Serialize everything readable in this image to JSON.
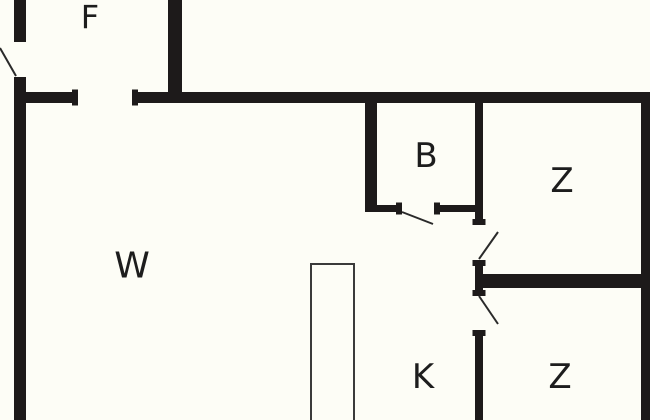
{
  "canvas": {
    "width": 650,
    "height": 420,
    "background_color": "#fdfdf6",
    "wall_color": "#1d1a1a",
    "door_line_color": "#2a2a2a",
    "counter_line_color": "#3a3a3a",
    "label_color": "#1d1d1d"
  },
  "plan": {
    "type": "floor-plan",
    "rooms": [
      {
        "id": "f",
        "label": "F",
        "cx": 90,
        "cy": 17,
        "font_size": 32
      },
      {
        "id": "w",
        "label": "W",
        "cx": 132,
        "cy": 266,
        "font_size": 36
      },
      {
        "id": "b",
        "label": "B",
        "cx": 426,
        "cy": 156,
        "font_size": 34
      },
      {
        "id": "z-top",
        "label": "Z",
        "cx": 562,
        "cy": 181,
        "font_size": 34
      },
      {
        "id": "k",
        "label": "K",
        "cx": 423,
        "cy": 377,
        "font_size": 34
      },
      {
        "id": "z-bottom",
        "label": "Z",
        "cx": 560,
        "cy": 377,
        "font_size": 34
      }
    ],
    "walls": [
      {
        "id": "left-wall-upper",
        "x": 14,
        "y": 0,
        "w": 12,
        "h": 42
      },
      {
        "id": "left-wall-main",
        "x": 14,
        "y": 77,
        "w": 12,
        "h": 343
      },
      {
        "id": "f-right-wall",
        "x": 168,
        "y": 0,
        "w": 14,
        "h": 103
      },
      {
        "id": "top-wall-left-seg",
        "x": 14,
        "y": 92,
        "w": 64,
        "h": 11
      },
      {
        "id": "top-wall-main-seg",
        "x": 132,
        "y": 92,
        "w": 518,
        "h": 11
      },
      {
        "id": "right-wall",
        "x": 641,
        "y": 92,
        "w": 9,
        "h": 328
      },
      {
        "id": "b-left-wall",
        "x": 365,
        "y": 103,
        "w": 12,
        "h": 109
      },
      {
        "id": "b-bottom-wall-left",
        "x": 365,
        "y": 205,
        "w": 37,
        "h": 7
      },
      {
        "id": "b-bottom-wall-right",
        "x": 434,
        "y": 205,
        "w": 49,
        "h": 7
      },
      {
        "id": "corridor-wall-upper",
        "x": 475,
        "y": 103,
        "w": 8,
        "h": 122
      },
      {
        "id": "corridor-wall-mid",
        "x": 475,
        "y": 260,
        "w": 8,
        "h": 36
      },
      {
        "id": "corridor-wall-lower",
        "x": 475,
        "y": 330,
        "w": 8,
        "h": 90
      },
      {
        "id": "between-z-wall",
        "x": 483,
        "y": 274,
        "w": 158,
        "h": 14
      },
      {
        "id": "cap-f-opening-left",
        "x": 72,
        "y": 89.5,
        "w": 6,
        "h": 16
      },
      {
        "id": "cap-f-opening-right",
        "x": 132,
        "y": 89.5,
        "w": 6,
        "h": 16
      },
      {
        "id": "cap-b-door-left",
        "x": 396,
        "y": 202.5,
        "w": 6,
        "h": 12
      },
      {
        "id": "cap-b-door-right",
        "x": 434,
        "y": 202.5,
        "w": 6,
        "h": 12
      },
      {
        "id": "cap-ztop-door-top",
        "x": 472.5,
        "y": 219,
        "w": 13,
        "h": 6
      },
      {
        "id": "cap-ztop-door-bottom",
        "x": 472.5,
        "y": 260,
        "w": 13,
        "h": 6
      },
      {
        "id": "cap-zbot-door-top",
        "x": 472.5,
        "y": 290,
        "w": 13,
        "h": 6
      },
      {
        "id": "cap-zbot-door-bottom",
        "x": 472.5,
        "y": 330,
        "w": 13,
        "h": 6
      }
    ],
    "door_swings": [
      {
        "id": "entry-door-swing",
        "x1": 0,
        "y1": 48,
        "x2": 16,
        "y2": 76
      },
      {
        "id": "b-door-swing",
        "x1": 402,
        "y1": 212,
        "x2": 433,
        "y2": 224
      },
      {
        "id": "z-top-door-swing",
        "x1": 479,
        "y1": 259,
        "x2": 498,
        "y2": 232
      },
      {
        "id": "z-bottom-door-swing",
        "x1": 479,
        "y1": 296,
        "x2": 498,
        "y2": 324
      }
    ],
    "counter": {
      "x": 311,
      "y": 264,
      "w": 43,
      "h": 156
    }
  }
}
